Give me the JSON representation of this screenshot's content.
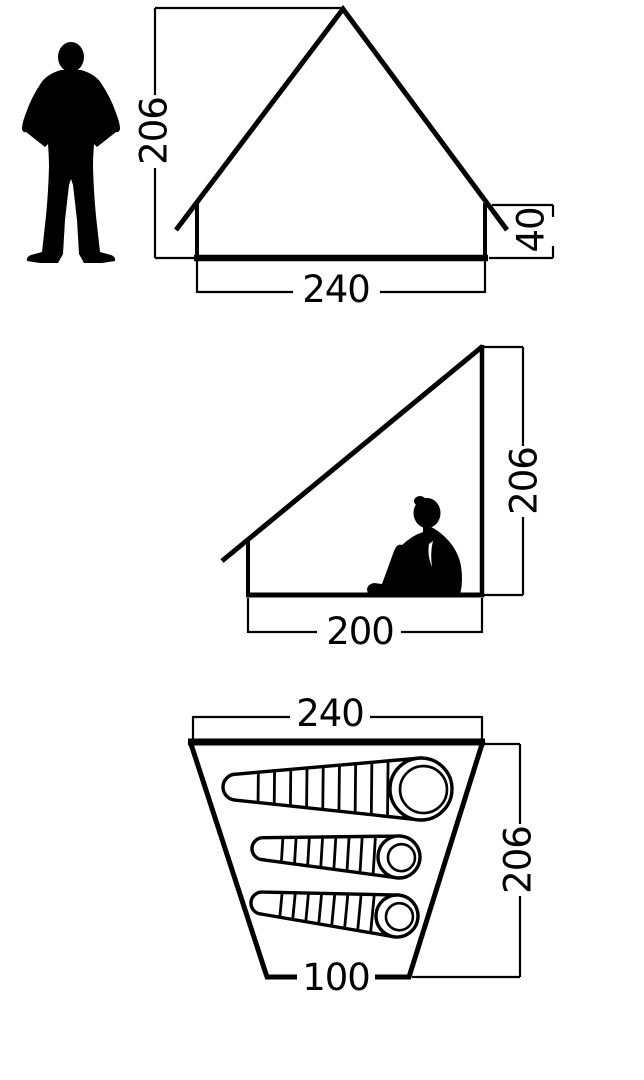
{
  "diagram": {
    "front_view": {
      "ridge_height": "206",
      "base_width": "240",
      "side_wall_height": "40"
    },
    "side_view": {
      "rear_height": "206",
      "floor_depth": "200"
    },
    "floor_plan": {
      "front_width": "240",
      "rear_width": "100",
      "depth": "206",
      "sleeping_bag_count": 3
    }
  },
  "icons": {
    "standing_person": "person-standing-silhouette",
    "sitting_person": "person-sitting-silhouette",
    "sleeping_bag": "sleeping-bag-top-view"
  },
  "colors": {
    "background": "#ffffff",
    "line": "#000000"
  }
}
